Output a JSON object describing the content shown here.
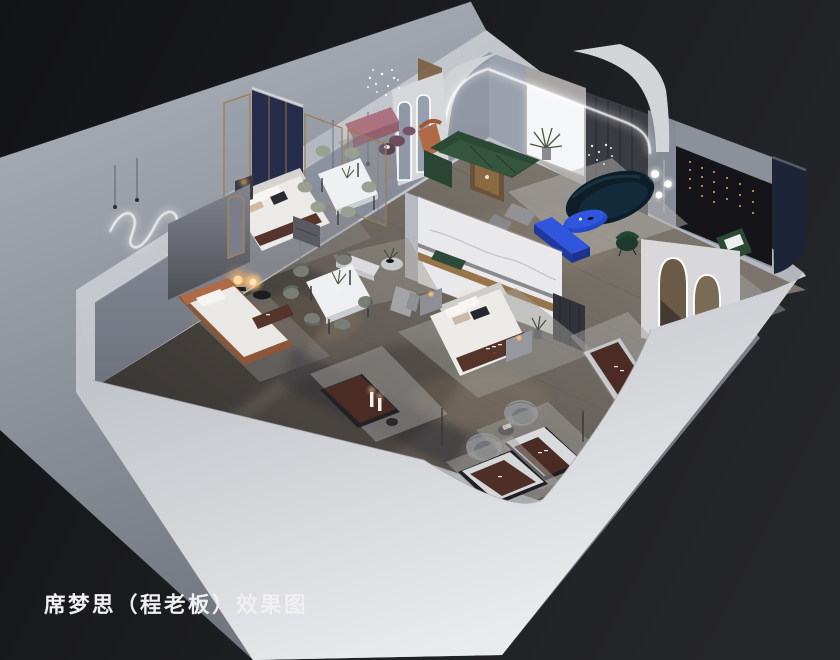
{
  "caption": {
    "text": "席梦思（程老板）效果图"
  },
  "scene": {
    "type": "3d-interior-render",
    "subject": "cutaway axonometric view of a mattress showroom"
  },
  "palette": {
    "bg_dark": "#17181b",
    "platform_gray": "#9ba0a8",
    "wall_light": "#c6c9ce",
    "wall_inner": "#868b97",
    "floor_wood": "#6b645e",
    "marble_white": "#e9e9eb",
    "gold_trim": "#97744a",
    "navy_panel": "#272c4a",
    "navy_wall": "#1e2438",
    "cobalt_blue": "#2f56dd",
    "teal_sofa": "#0d1e29",
    "green_sofa": "#2c4936",
    "pink_bench": "#ad7280",
    "plum_pouf": "#6f4b5e",
    "orange_accent": "#b06a45",
    "mattress_brown": "#4b2c25",
    "runner_brown": "#55352b",
    "art_wall": "#141419",
    "drape_gray": "#3b3c41",
    "chair_gray": "#8e8f93",
    "rug_gray": "#a3a2a0",
    "led_white": "#ffffff",
    "warm_glow": "#ffc078",
    "caption_white": "#f0f0f1"
  },
  "objects": [
    "platform",
    "outer-walls",
    "inner-wall-nw",
    "inner-wall-ne",
    "wood-floor",
    "neon-squiggle-light",
    "pendant-lights",
    "crystal-chandelier",
    "led-arch-portal",
    "backlit-panel",
    "palm-plant",
    "curtain-panel",
    "art-wall-string-lights",
    "navy-accent-wall",
    "navy-headboard-wall",
    "glass-partition",
    "bed-display-1",
    "bed-display-2",
    "single-bed-orange",
    "nightstand",
    "dining-set-upper",
    "dining-set-lower",
    "pink-bench",
    "plum-poufs",
    "orange-armchair",
    "standing-arch-mirrors",
    "wood-display-case",
    "green-sectional-sofa",
    "teal-curved-sofa",
    "blue-coffee-table",
    "blue-tv-bench",
    "gray-ottomans",
    "green-accent-chair",
    "floor-lamp",
    "green-chair-white-pillow",
    "arch-mirror-panel",
    "marble-feature-wall",
    "console-table",
    "round-side-table",
    "daybed",
    "mattress-displays",
    "swivel-chairs",
    "side-drum-table",
    "candle-display",
    "area-rugs",
    "sphere-table-lamp",
    "caption"
  ]
}
